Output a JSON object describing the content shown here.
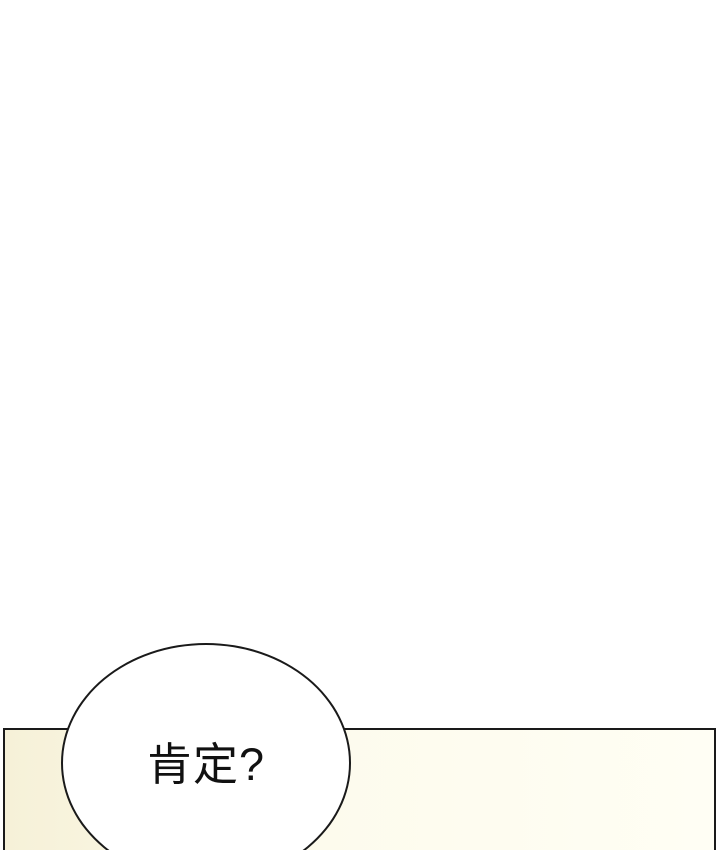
{
  "speech_bubble": {
    "text": "肯定?"
  },
  "colors": {
    "page_bg": "#ffffff",
    "panel_fill_left": "#f6f1d8",
    "panel_fill_mid": "#fdfbed",
    "panel_fill_right": "#fffef4",
    "bubble_fill": "#ffffff",
    "line": "#1a1a1a",
    "text": "#111111"
  }
}
